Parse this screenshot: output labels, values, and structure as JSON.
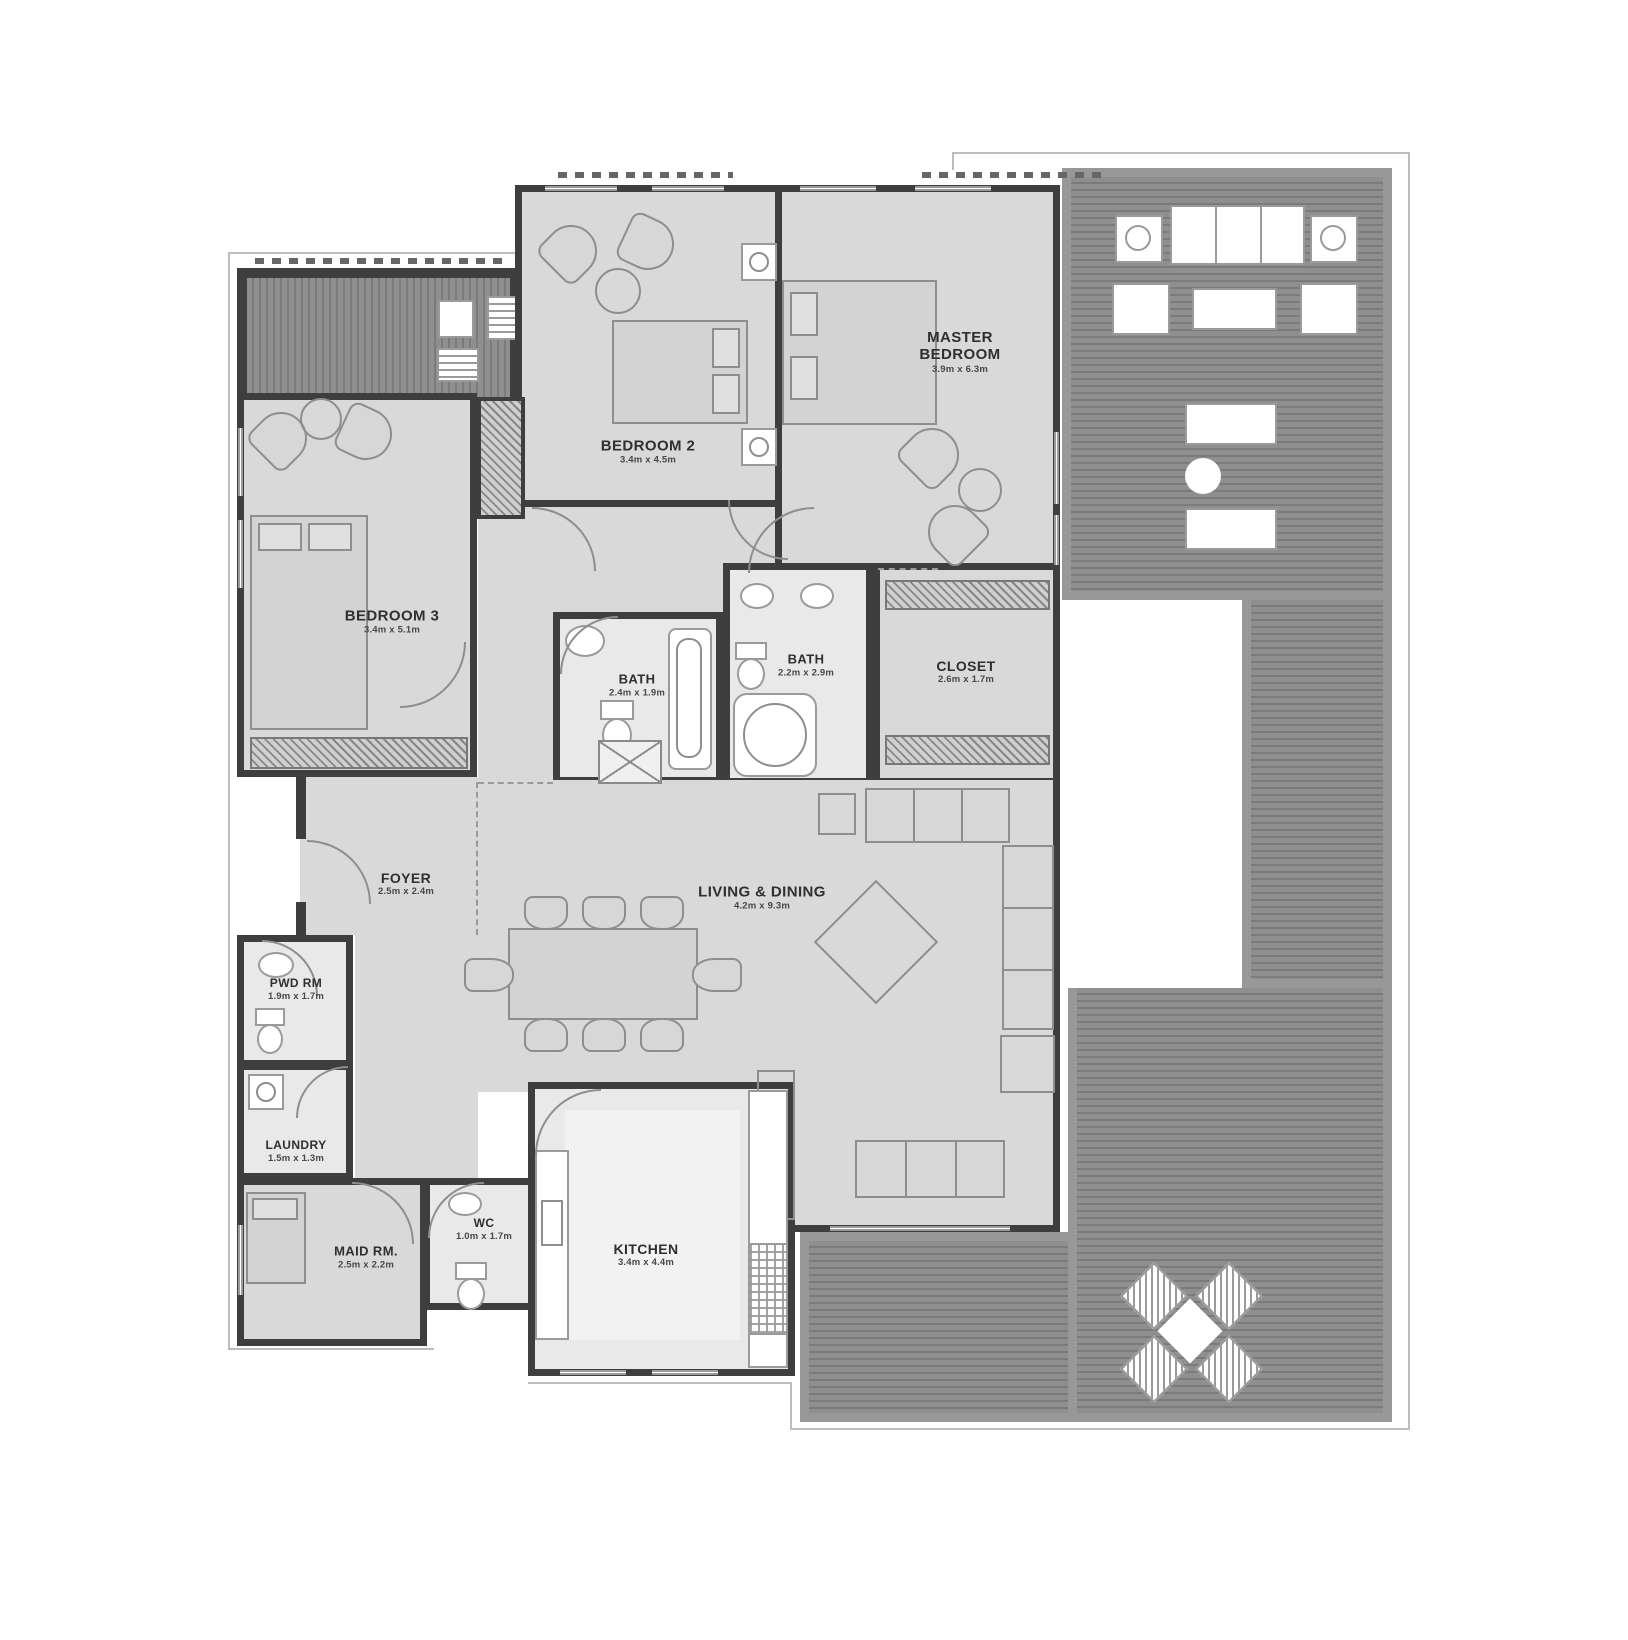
{
  "plan": {
    "colors": {
      "wall": "#3e3e3e",
      "room": "#d9d9d9",
      "wet": "#e9e9e9",
      "deck": "#8f8f8f",
      "deckline": "#7b7b7b",
      "furnline": "#8e8e8e",
      "text": "#2f2f2f"
    },
    "rooms": {
      "master": {
        "label": "MASTER BEDROOM",
        "dims": "3.9m x 6.3m"
      },
      "bedroom2": {
        "label": "BEDROOM 2",
        "dims": "3.4m x 4.5m"
      },
      "bedroom3": {
        "label": "BEDROOM 3",
        "dims": "3.4m x 5.1m"
      },
      "bath1": {
        "label": "BATH",
        "dims": "2.4m x 1.9m"
      },
      "bath2": {
        "label": "BATH",
        "dims": "2.2m x 2.9m"
      },
      "closet": {
        "label": "CLOSET",
        "dims": "2.6m x 1.7m"
      },
      "foyer": {
        "label": "FOYER",
        "dims": "2.5m x 2.4m"
      },
      "living": {
        "label": "LIVING & DINING",
        "dims": "4.2m x 9.3m"
      },
      "pwd": {
        "label": "PWD RM",
        "dims": "1.9m x 1.7m"
      },
      "laundry": {
        "label": "LAUNDRY",
        "dims": "1.5m x 1.3m"
      },
      "maid": {
        "label": "MAID RM.",
        "dims": "2.5m x 2.2m"
      },
      "wc": {
        "label": "WC",
        "dims": "1.0m x 1.7m"
      },
      "kitchen": {
        "label": "KITCHEN",
        "dims": "3.4m x 4.4m"
      }
    }
  }
}
